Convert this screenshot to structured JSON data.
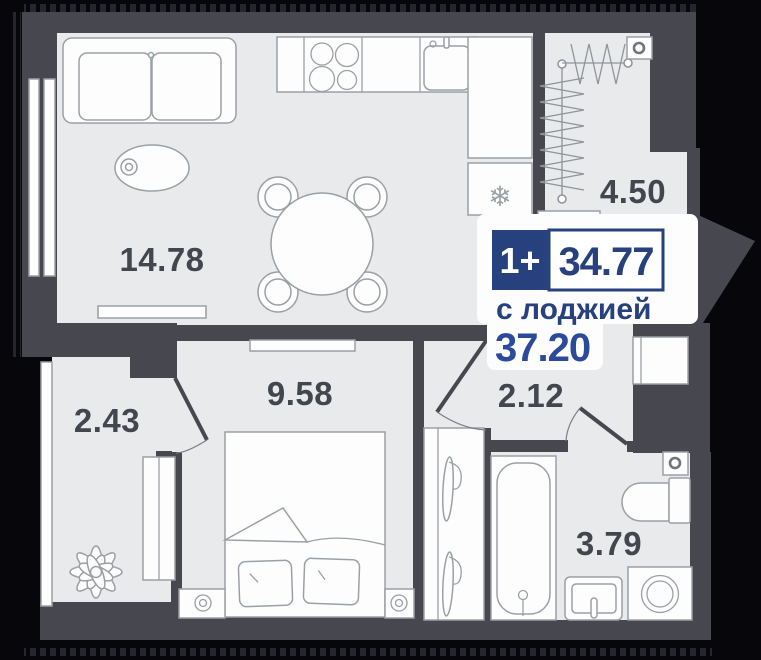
{
  "badge": {
    "type": "1+",
    "area": "34.77",
    "with_loggia_label": "с лоджией",
    "with_loggia_area": "37.20"
  },
  "rooms": {
    "living_kitchen": "14.78",
    "drying_balcony": "4.50",
    "bedroom": "9.58",
    "hallway": "2.12",
    "bathroom": "3.79",
    "loggia": "2.43"
  },
  "icons": {
    "fridge_snowflake": "❄"
  },
  "colors": {
    "background": "#06060b",
    "wall": "#474750",
    "floor": "#e9eaeb",
    "furniture_line": "#9ba0a5",
    "label": "#42464e",
    "navy": "#26417d",
    "accent_blue": "#2b4a9b",
    "white": "#ffffff"
  }
}
